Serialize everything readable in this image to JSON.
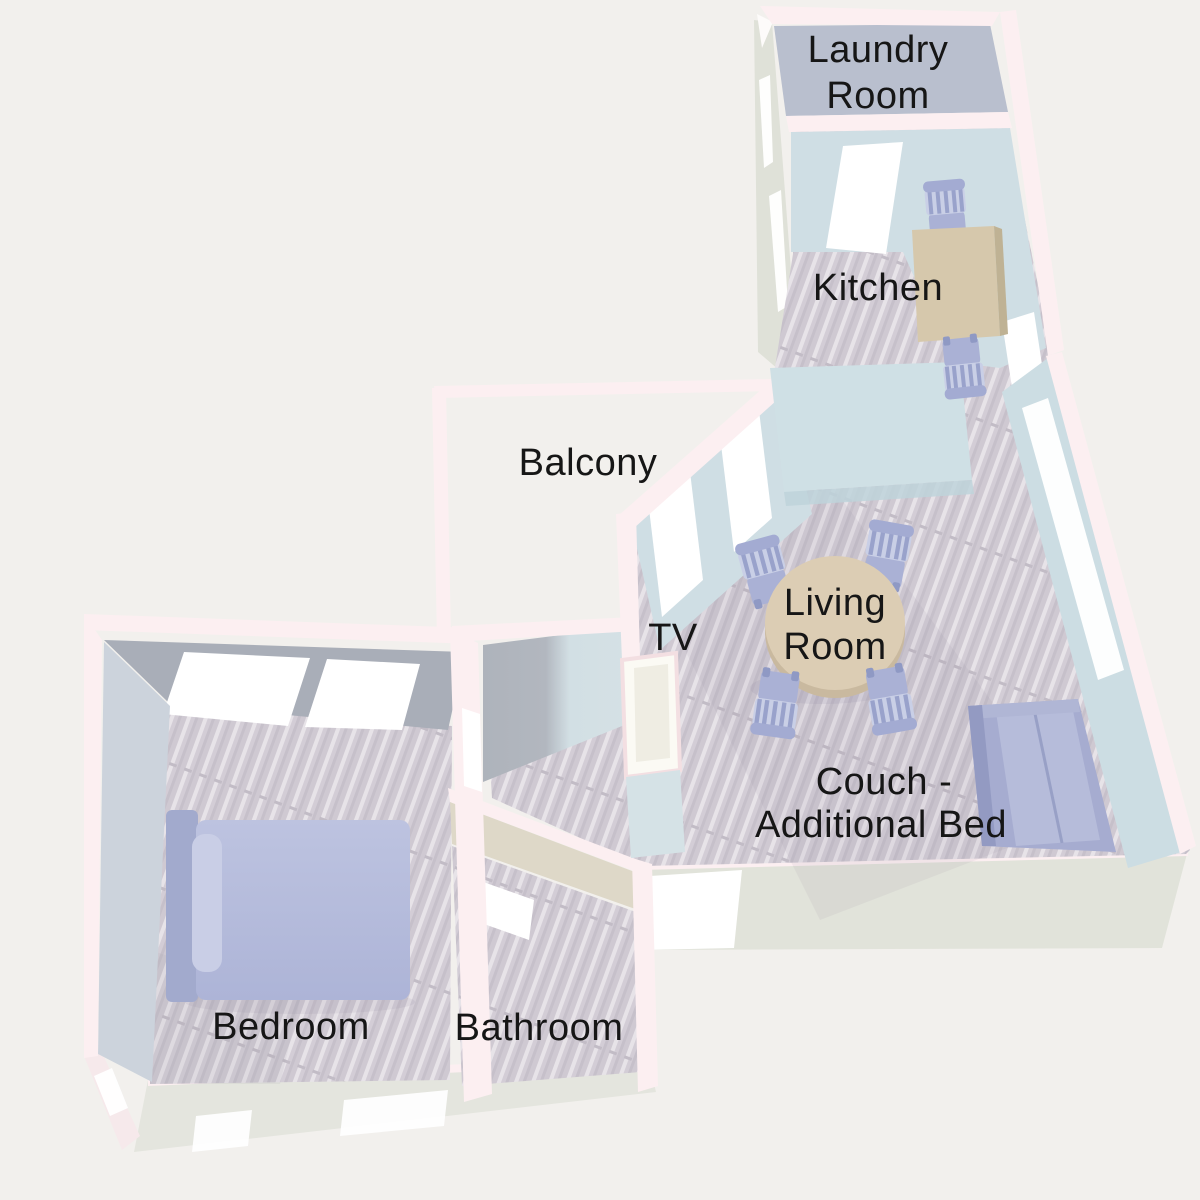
{
  "app": {
    "type": "3d-floor-plan-render"
  },
  "colors": {
    "background": "#f2f0ed",
    "wall_cap_pink": "#fceff1",
    "interior_wall_blue": "#cfdee4",
    "exterior_wall_gray_green": "#dfe1d8",
    "laundry_floor_gray": "#b9bfce",
    "wood_floor": "#d9d4db",
    "bedroom_wall_gray": "#a9aeb8",
    "bathroom_wall_beige": "#ded8c8",
    "furniture_lavender": "#a9b0d3",
    "table_tan": "#dccdb4",
    "label_text": "#161616"
  },
  "labels": {
    "laundry_line1": "Laundry",
    "laundry_line2": "Room",
    "kitchen": "Kitchen",
    "balcony": "Balcony",
    "tv": "TV",
    "living_line1": "Living",
    "living_line2": "Room",
    "couch_line1": "Couch -",
    "couch_line2": "Additional Bed",
    "bedroom": "Bedroom",
    "bathroom": "Bathroom"
  }
}
